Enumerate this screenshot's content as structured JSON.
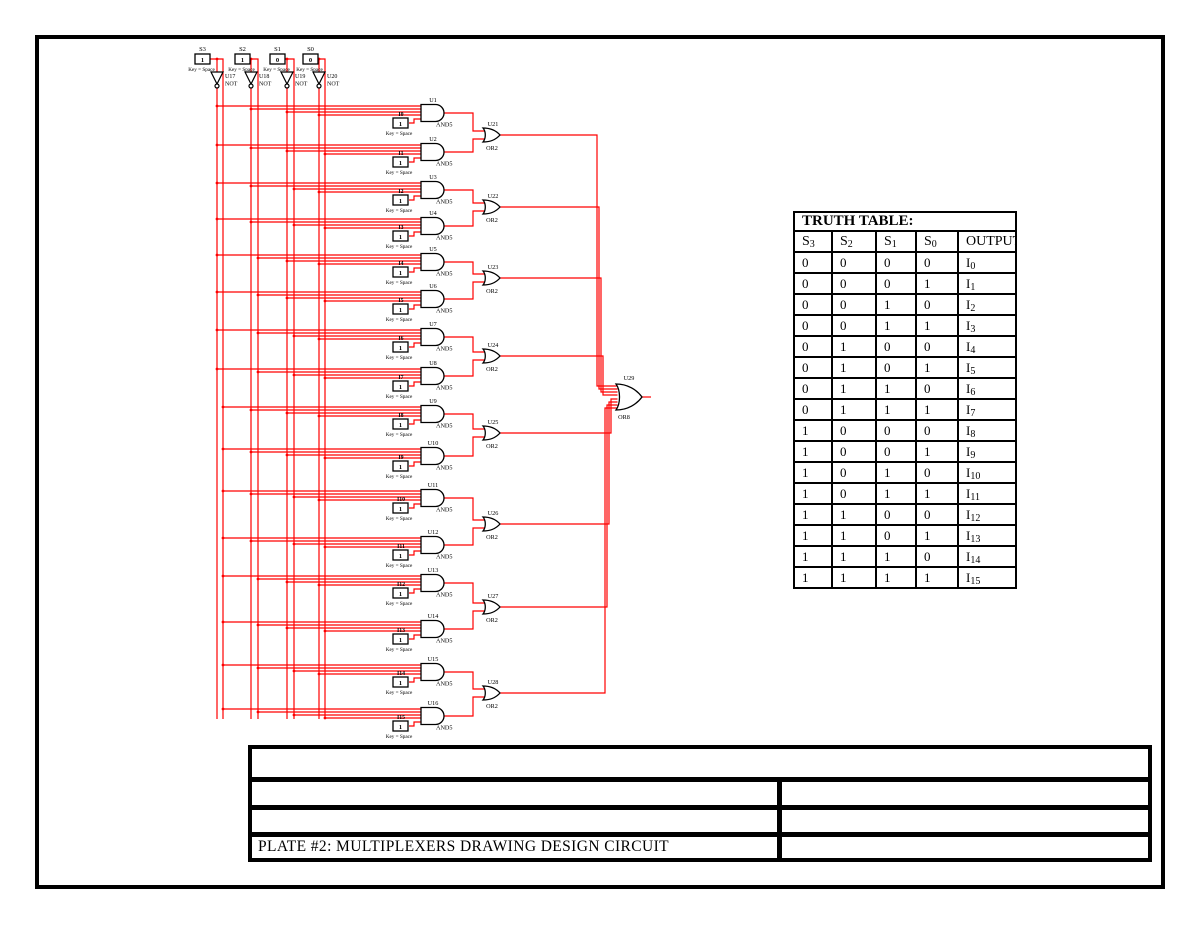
{
  "colors": {
    "wire": "#ff0000",
    "component": "#000000",
    "led": "#008000",
    "ink": "#000000"
  },
  "schematic": {
    "key_label": "Key = Space",
    "select_switches": [
      {
        "label": "S3",
        "value": "1",
        "not_label": "U17",
        "not_type": "NOT"
      },
      {
        "label": "S2",
        "value": "1",
        "not_label": "U18",
        "not_type": "NOT"
      },
      {
        "label": "S1",
        "value": "0",
        "not_label": "U19",
        "not_type": "NOT"
      },
      {
        "label": "S0",
        "value": "0",
        "not_label": "U20",
        "not_type": "NOT"
      }
    ],
    "and_gates": [
      {
        "label": "U1",
        "type": "AND5",
        "input_label": "I0",
        "input_value": "1"
      },
      {
        "label": "U2",
        "type": "AND5",
        "input_label": "I1",
        "input_value": "1"
      },
      {
        "label": "U3",
        "type": "AND5",
        "input_label": "I2",
        "input_value": "1"
      },
      {
        "label": "U4",
        "type": "AND5",
        "input_label": "I3",
        "input_value": "1"
      },
      {
        "label": "U5",
        "type": "AND5",
        "input_label": "I4",
        "input_value": "1"
      },
      {
        "label": "U6",
        "type": "AND5",
        "input_label": "I5",
        "input_value": "1"
      },
      {
        "label": "U7",
        "type": "AND5",
        "input_label": "I6",
        "input_value": "1"
      },
      {
        "label": "U8",
        "type": "AND5",
        "input_label": "I7",
        "input_value": "1"
      },
      {
        "label": "U9",
        "type": "AND5",
        "input_label": "I8",
        "input_value": "1"
      },
      {
        "label": "U10",
        "type": "AND5",
        "input_label": "I9",
        "input_value": "1"
      },
      {
        "label": "U11",
        "type": "AND5",
        "input_label": "I10",
        "input_value": "1"
      },
      {
        "label": "U12",
        "type": "AND5",
        "input_label": "I11",
        "input_value": "1"
      },
      {
        "label": "U13",
        "type": "AND5",
        "input_label": "I12",
        "input_value": "1"
      },
      {
        "label": "U14",
        "type": "AND5",
        "input_label": "I13",
        "input_value": "1"
      },
      {
        "label": "U15",
        "type": "AND5",
        "input_label": "I14",
        "input_value": "1"
      },
      {
        "label": "U16",
        "type": "AND5",
        "input_label": "I15",
        "input_value": "1"
      }
    ],
    "or_gates": [
      {
        "label": "U21",
        "type": "OR2"
      },
      {
        "label": "U22",
        "type": "OR2"
      },
      {
        "label": "U23",
        "type": "OR2"
      },
      {
        "label": "U24",
        "type": "OR2"
      },
      {
        "label": "U25",
        "type": "OR2"
      },
      {
        "label": "U26",
        "type": "OR2"
      },
      {
        "label": "U27",
        "type": "OR2"
      },
      {
        "label": "U28",
        "type": "OR2"
      }
    ],
    "final_gate": {
      "label": "U29",
      "type": "OR8"
    },
    "led": {
      "ref": "X1",
      "type": "LED"
    }
  },
  "truth_table": {
    "title": "TRUTH TABLE:",
    "headers": [
      {
        "base": "S",
        "sub": "3"
      },
      {
        "base": "S",
        "sub": "2"
      },
      {
        "base": "S",
        "sub": "1"
      },
      {
        "base": "S",
        "sub": "0"
      },
      {
        "base": "OUTPUT",
        "sub": ""
      }
    ],
    "rows": [
      {
        "bits": [
          "0",
          "0",
          "0",
          "0"
        ],
        "out_base": "I",
        "out_sub": "0"
      },
      {
        "bits": [
          "0",
          "0",
          "0",
          "1"
        ],
        "out_base": "I",
        "out_sub": "1"
      },
      {
        "bits": [
          "0",
          "0",
          "1",
          "0"
        ],
        "out_base": "I",
        "out_sub": "2"
      },
      {
        "bits": [
          "0",
          "0",
          "1",
          "1"
        ],
        "out_base": "I",
        "out_sub": "3"
      },
      {
        "bits": [
          "0",
          "1",
          "0",
          "0"
        ],
        "out_base": "I",
        "out_sub": "4"
      },
      {
        "bits": [
          "0",
          "1",
          "0",
          "1"
        ],
        "out_base": "I",
        "out_sub": "5"
      },
      {
        "bits": [
          "0",
          "1",
          "1",
          "0"
        ],
        "out_base": "I",
        "out_sub": "6"
      },
      {
        "bits": [
          "0",
          "1",
          "1",
          "1"
        ],
        "out_base": "I",
        "out_sub": "7"
      },
      {
        "bits": [
          "1",
          "0",
          "0",
          "0"
        ],
        "out_base": "I",
        "out_sub": "8"
      },
      {
        "bits": [
          "1",
          "0",
          "0",
          "1"
        ],
        "out_base": "I",
        "out_sub": "9"
      },
      {
        "bits": [
          "1",
          "0",
          "1",
          "0"
        ],
        "out_base": "I",
        "out_sub": "10"
      },
      {
        "bits": [
          "1",
          "0",
          "1",
          "1"
        ],
        "out_base": "I",
        "out_sub": "11"
      },
      {
        "bits": [
          "1",
          "1",
          "0",
          "0"
        ],
        "out_base": "I",
        "out_sub": "12"
      },
      {
        "bits": [
          "1",
          "1",
          "0",
          "1"
        ],
        "out_base": "I",
        "out_sub": "13"
      },
      {
        "bits": [
          "1",
          "1",
          "1",
          "0"
        ],
        "out_base": "I",
        "out_sub": "14"
      },
      {
        "bits": [
          "1",
          "1",
          "1",
          "1"
        ],
        "out_base": "I",
        "out_sub": "15"
      }
    ]
  },
  "title_block": {
    "title": "PLATE #2: MULTIPLEXERS DRAWING DESIGN CIRCUIT"
  }
}
